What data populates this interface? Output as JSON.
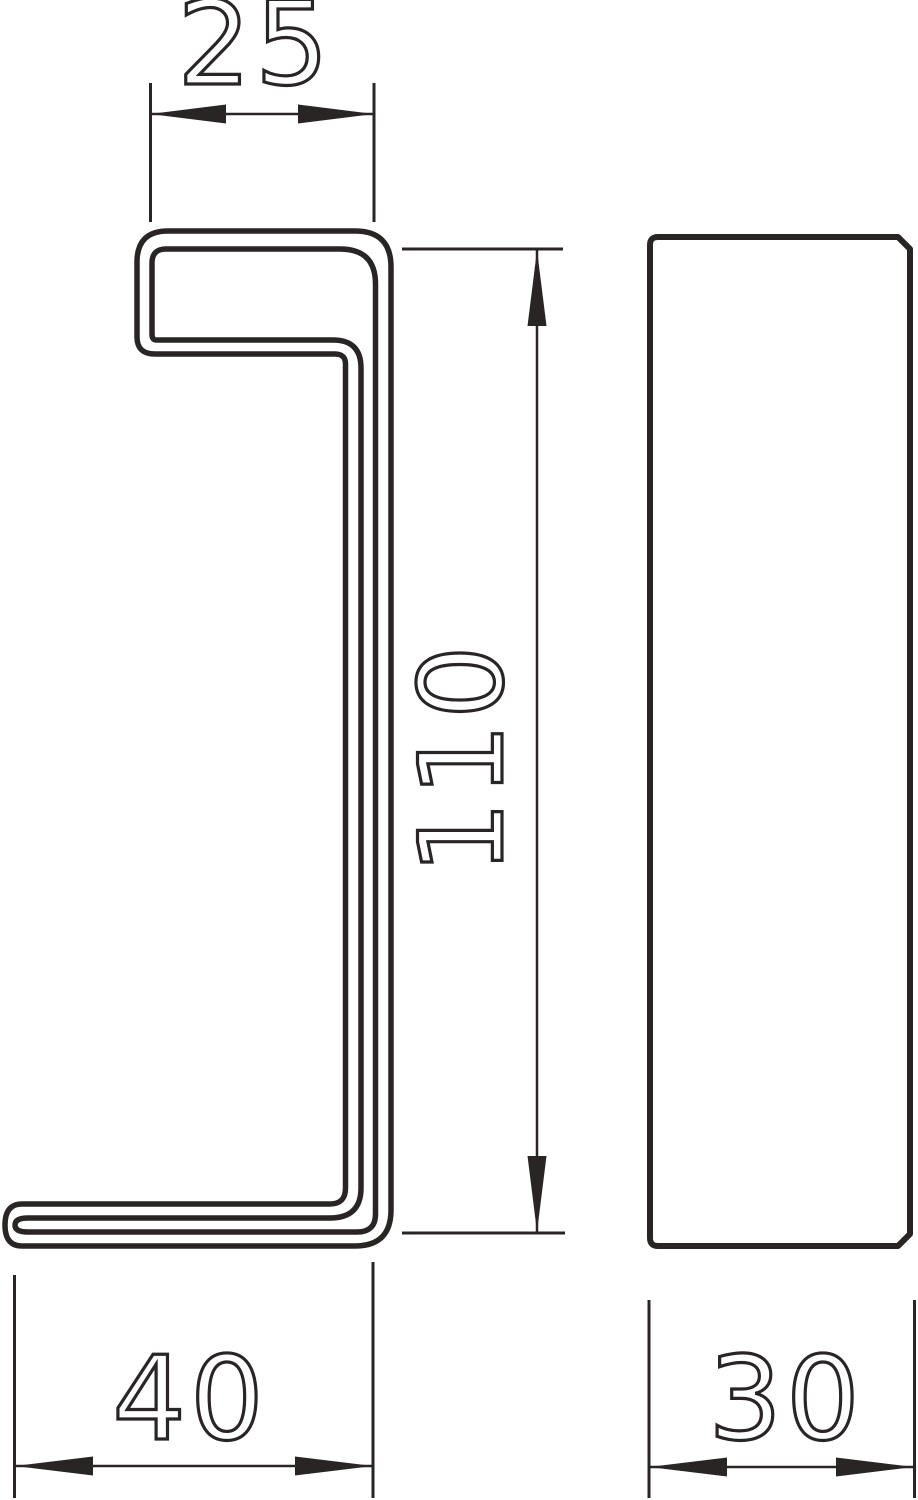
{
  "page": {
    "background": "#ffffff",
    "line_color": "#2a2525"
  },
  "dimensions": {
    "top_width": "25",
    "height": "110",
    "bottom_width": "40",
    "side_depth": "30"
  }
}
